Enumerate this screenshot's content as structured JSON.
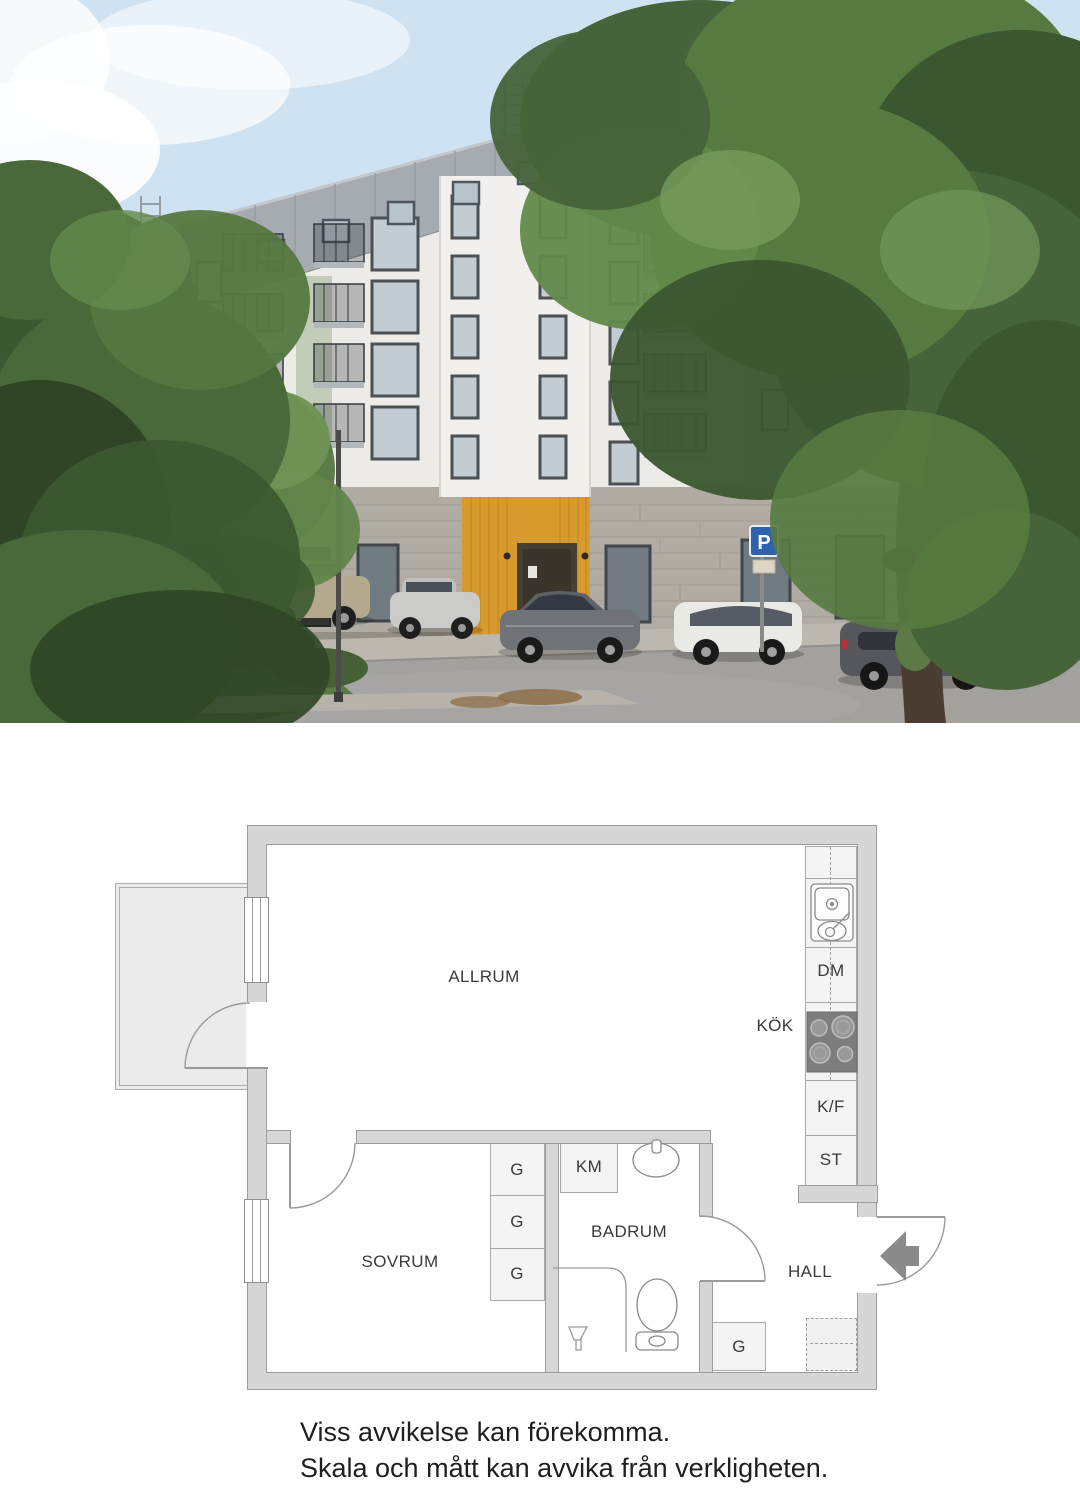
{
  "photo": {
    "parking_sign_label": "P"
  },
  "floorplan": {
    "labels": {
      "allrum": "ALLRUM",
      "kok": "KÖK",
      "dm": "DM",
      "kf": "K/F",
      "st": "ST",
      "km": "KM",
      "badrum": "BADRUM",
      "sovrum": "SOVRUM",
      "hall": "HALL",
      "g": "G"
    }
  },
  "disclaimer": {
    "line1": "Viss avvikelse kan förekomma.",
    "line2": "Skala och mått kan avvika från verkligheten."
  }
}
